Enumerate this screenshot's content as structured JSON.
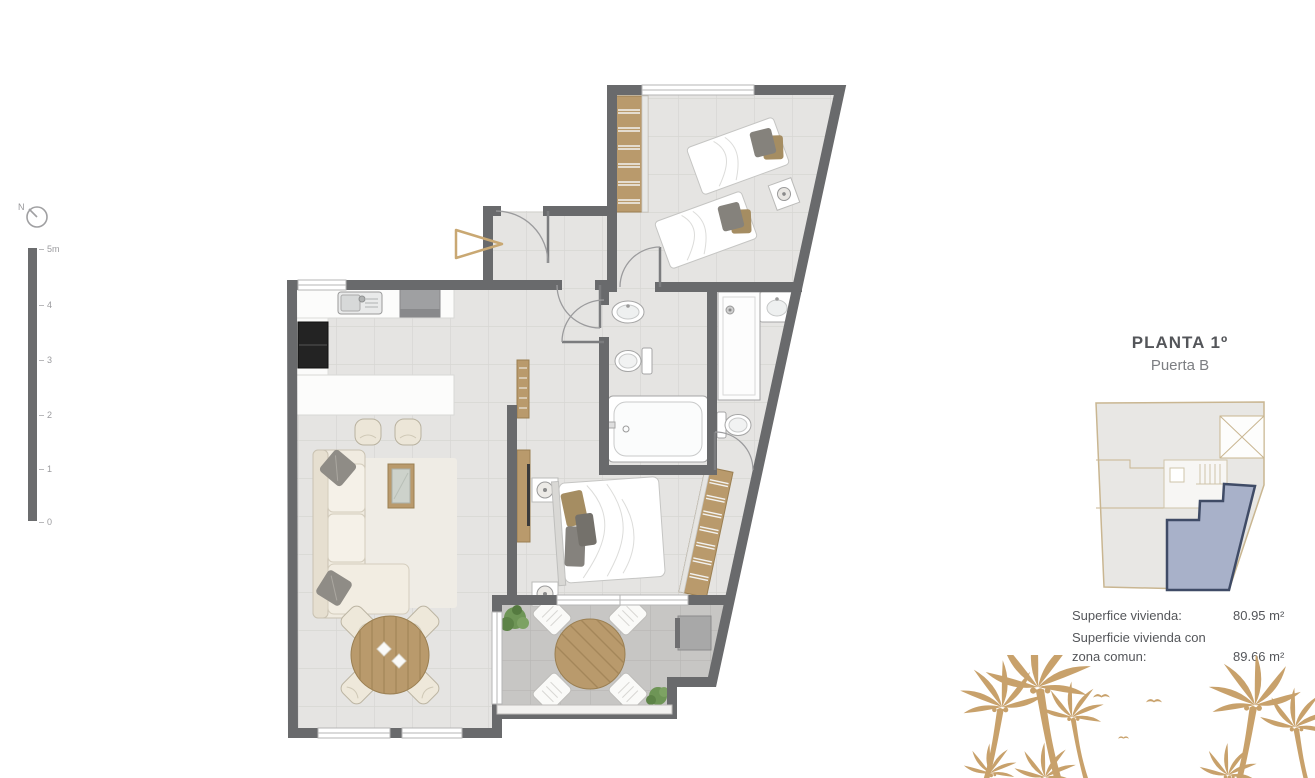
{
  "window": {
    "width": 1315,
    "height": 778,
    "background": "#ffffff"
  },
  "legend": {
    "north_label": "N",
    "scale_ticks": [
      "5m",
      "4",
      "3",
      "2",
      "1",
      "0"
    ]
  },
  "plan": {
    "colors": {
      "wall": "#696a6c",
      "floor": "#e5e4e2",
      "floor_grout": "#d7d6d3",
      "terrace_floor": "#c7c6c4",
      "terrace_grout": "#b8b7b5",
      "wood": "#b99a6c",
      "entry_marker": "#c9a873",
      "plant": "#6e9556"
    }
  },
  "panel": {
    "title": "PLANTA 1º",
    "subtitle": "Puerta B",
    "keyplan": {
      "building_fill": "#e8e7e4",
      "building_stroke": "#c9b691",
      "unit_fill": "#a8b1c9",
      "unit_stroke": "#3f4b66"
    },
    "info_rows": [
      {
        "label_line1": "Superfice vivienda:",
        "label_line2": "",
        "value": "80.95 m²"
      },
      {
        "label_line1": "Superficie vivienda con",
        "label_line2": "zona comun:",
        "value": "89.66 m²"
      }
    ]
  },
  "decor": {
    "palm_color": "#c8a16b"
  }
}
